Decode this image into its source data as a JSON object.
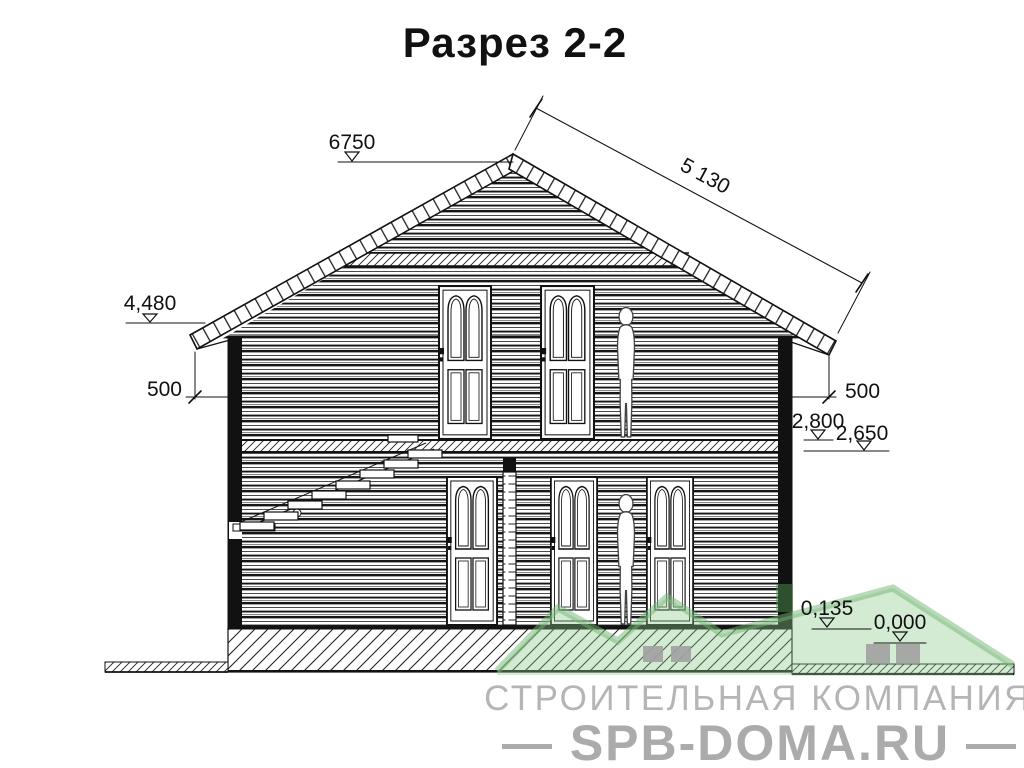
{
  "title": "Разрез 2-2",
  "dimensions": {
    "ridge_level": "6750",
    "roof_slope_length": "5 130",
    "eave_level": "4,480",
    "eave_drop_left": "500",
    "eave_drop_right": "500",
    "floor2_level": "2,800",
    "ceiling1_level": "2,650",
    "plinth_level": "0,135",
    "ground_level": "0,000"
  },
  "watermark": {
    "company": "СТРОИТЕЛЬНАЯ КОМПАНИЯ",
    "website": "— SPB-DOMA.RU —",
    "green_accent": "#8cc98c",
    "gray_text": "#b3b3b3"
  },
  "drawing": {
    "line_color": "#111111"
  }
}
